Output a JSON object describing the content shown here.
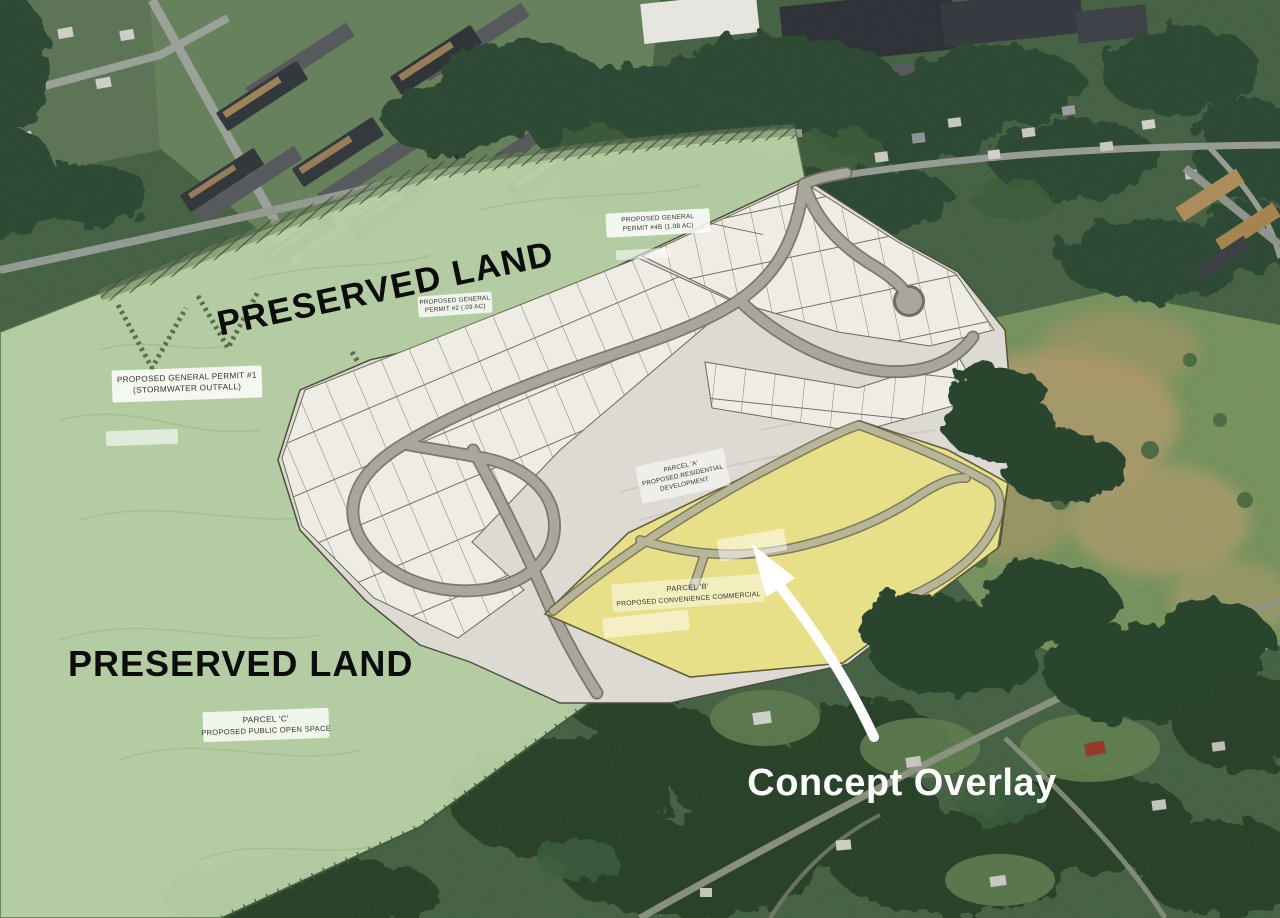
{
  "annotations": {
    "preserved_land_upper": "PRESERVED LAND",
    "preserved_land_lower": "PRESERVED LAND",
    "concept_overlay": "Concept Overlay"
  },
  "plan_labels": {
    "permit_1_line1": "PROPOSED GENERAL PERMIT #1",
    "permit_1_line2": "(STORMWATER OUTFALL)",
    "permit_2_line1": "PROPOSED GENERAL",
    "permit_2_line2": "PERMIT #2 (.09 AC)",
    "permit_4b_line1": "PROPOSED GENERAL",
    "permit_4b_line2": "PERMIT #4B (1.08 AC)",
    "parcel_a_line1": "PARCEL 'A'",
    "parcel_a_line2": "PROPOSED RESIDENTIAL",
    "parcel_a_line3": "DEVELOPMENT",
    "parcel_b_line1": "PARCEL 'B'",
    "parcel_b_line2": "PROPOSED CONVENIENCE COMMERCIAL",
    "parcel_c_line1": "PARCEL 'C'",
    "parcel_c_line2": "PROPOSED PUBLIC OPEN SPACE"
  },
  "colors": {
    "preserved_land_green": "#bdd5ab",
    "concept_parcel_yellow": "#e9e187",
    "plat_gray": "#dcdad3",
    "lot_fill": "#eeece5",
    "road_gray": "#a9a79c",
    "annotation_black": "#0c0c0c",
    "annotation_white": "#ffffff"
  }
}
